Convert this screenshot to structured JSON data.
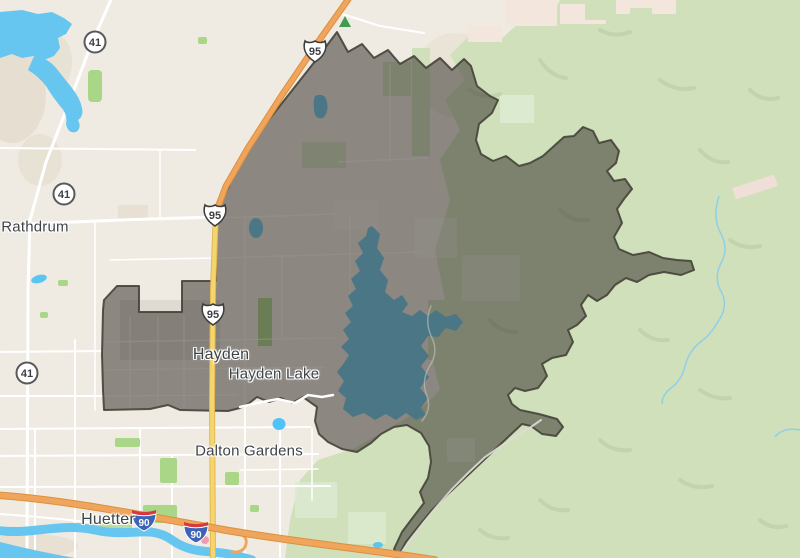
{
  "map": {
    "region_name": "Hayden area boundary map",
    "labels": {
      "rathdrum": "Rathdrum",
      "hayden": "Hayden",
      "hayden_lake": "Hayden Lake",
      "dalton_gardens": "Dalton Gardens",
      "huetter": "Huetter"
    },
    "shields": {
      "us95": "95",
      "sr41": "41",
      "i90": "90"
    }
  },
  "colors": {
    "land": "#f0ebe2",
    "land-shade": "#e3dccd",
    "urban-pink": "#f2e6dd",
    "forest": "#cfe0ba",
    "forest-shade": "#b7cba2",
    "forest-light": "#dcead0",
    "park": "#a9d687",
    "water": "#67c6ef",
    "road": "#ffffff",
    "highway-orange": "#f1a45c",
    "highway-orange-casing": "#d8913f",
    "highway-yellow": "#f6d56d",
    "highway-yellow-casing": "#dfb954",
    "overlay": "#2f2c27",
    "overlay-border": "#454238",
    "label": "#3e4348",
    "shield-blue": "#3d63b8",
    "shield-red": "#d63a3a"
  }
}
